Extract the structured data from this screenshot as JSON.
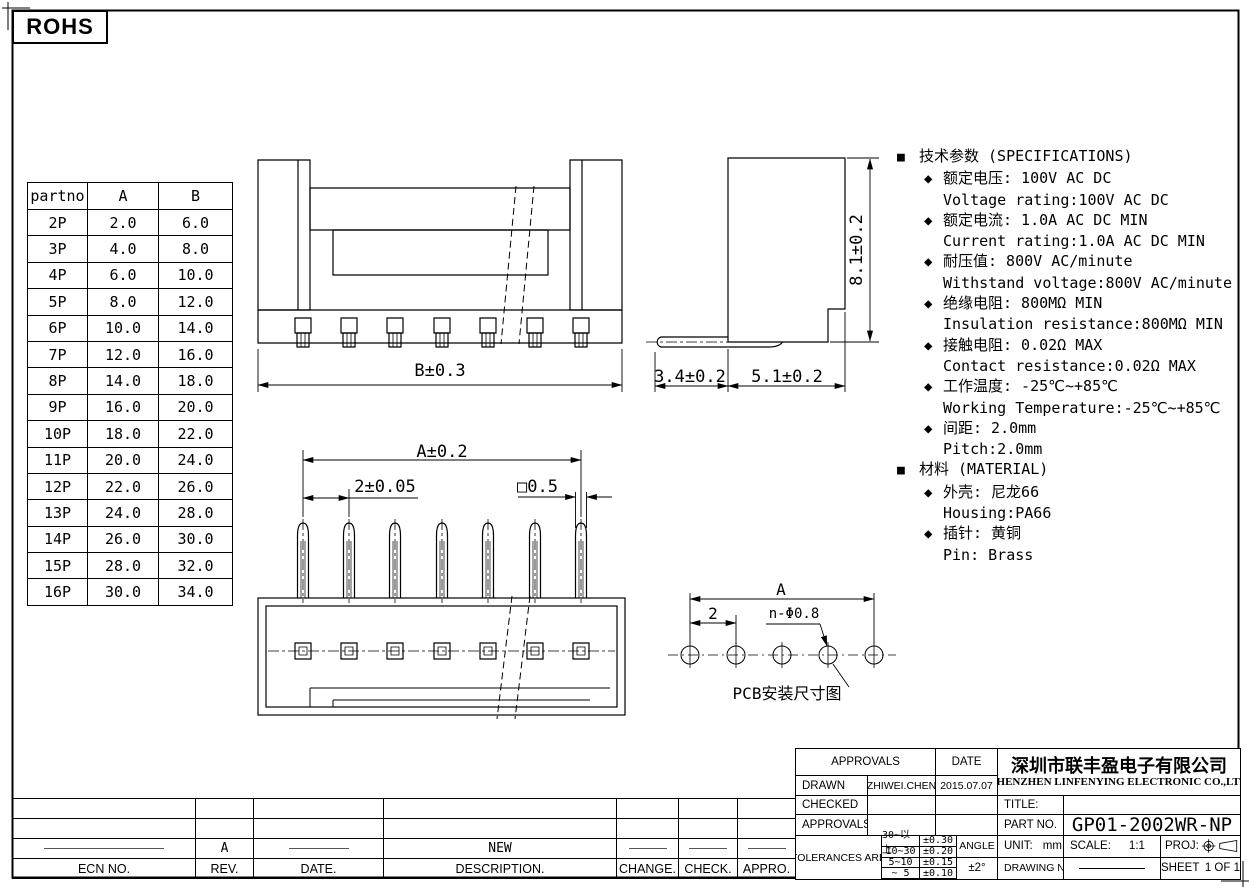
{
  "rohs": {
    "label": "ROHS"
  },
  "icons": {
    "square_bullet": "■",
    "diamond_bullet": "◆"
  },
  "part_table": {
    "headers": {
      "partno": "partno",
      "a": "A",
      "b": "B"
    },
    "rows": [
      {
        "partno": "2P",
        "a": "2.0",
        "b": "6.0"
      },
      {
        "partno": "3P",
        "a": "4.0",
        "b": "8.0"
      },
      {
        "partno": "4P",
        "a": "6.0",
        "b": "10.0"
      },
      {
        "partno": "5P",
        "a": "8.0",
        "b": "12.0"
      },
      {
        "partno": "6P",
        "a": "10.0",
        "b": "14.0"
      },
      {
        "partno": "7P",
        "a": "12.0",
        "b": "16.0"
      },
      {
        "partno": "8P",
        "a": "14.0",
        "b": "18.0"
      },
      {
        "partno": "9P",
        "a": "16.0",
        "b": "20.0"
      },
      {
        "partno": "10P",
        "a": "18.0",
        "b": "22.0"
      },
      {
        "partno": "11P",
        "a": "20.0",
        "b": "24.0"
      },
      {
        "partno": "12P",
        "a": "22.0",
        "b": "26.0"
      },
      {
        "partno": "13P",
        "a": "24.0",
        "b": "28.0"
      },
      {
        "partno": "14P",
        "a": "26.0",
        "b": "30.0"
      },
      {
        "partno": "15P",
        "a": "28.0",
        "b": "32.0"
      },
      {
        "partno": "16P",
        "a": "30.0",
        "b": "34.0"
      }
    ]
  },
  "specs": {
    "spec_heading": "技术参数 (SPECIFICATIONS)",
    "spec_items": [
      {
        "cn": "额定电压: 100V AC DC",
        "en": "Voltage rating:100V AC DC"
      },
      {
        "cn": "额定电流: 1.0A AC DC MIN",
        "en": "Current rating:1.0A AC DC MIN"
      },
      {
        "cn": "耐压值: 800V AC/minute",
        "en": "Withstand voltage:800V AC/minute"
      },
      {
        "cn": "绝缘电阻: 800MΩ MIN",
        "en": "Insulation resistance:800MΩ MIN"
      },
      {
        "cn": "接触电阻: 0.02Ω MAX",
        "en": "Contact resistance:0.02Ω MAX"
      },
      {
        "cn": "工作温度: -25℃~+85℃",
        "en": "Working Temperature:-25℃~+85℃"
      },
      {
        "cn": "间距: 2.0mm",
        "en": "Pitch:2.0mm"
      }
    ],
    "material_heading": "材料 (MATERIAL)",
    "material_items": [
      {
        "cn": "外壳: 尼龙66",
        "en": "Housing:PA66"
      },
      {
        "cn": "插针: 黄铜",
        "en": "Pin: Brass"
      }
    ]
  },
  "dimensions": {
    "front_width": "B±0.3",
    "top_width": "A±0.2",
    "pitch": "2±0.05",
    "pin_square": "□0.5",
    "side_height": "8.1±0.2",
    "pin_length": "3.4±0.2",
    "body_depth": "5.1±0.2"
  },
  "pcb": {
    "width_label": "A",
    "pitch_label": "2",
    "hole_label": "n-Φ0.8",
    "caption": "PCB安装尺寸图"
  },
  "revision": {
    "headers": [
      "ECN NO.",
      "REV.",
      "DATE.",
      "DESCRIPTION.",
      "CHANGE.",
      "CHECK.",
      "APPRO."
    ],
    "entry": {
      "rev": "A",
      "description": "NEW"
    }
  },
  "title_block": {
    "approvals_header": "APPROVALS",
    "date_header": "DATE",
    "drawn_label": "DRAWN",
    "drawn_name": "ZHIWEI.CHEN",
    "drawn_date": "2015.07.07",
    "checked_label": "CHECKED",
    "approved_label": "APPROVALS",
    "tolerances_label": "TOLERANCES ARE",
    "tolerances": [
      {
        "range": "30~以上",
        "tol": "±0.30"
      },
      {
        "range": "10~30",
        "tol": "±0.20"
      },
      {
        "range": "5~10",
        "tol": "±0.15"
      },
      {
        "range": "~ 5",
        "tol": "±0.10"
      }
    ],
    "angle_label": "ANGLE",
    "angle_tol": "±2°",
    "company_cn": "深圳市联丰盈电子有限公司",
    "company_en": "SHENZHEN LINFENYING ELECTRONIC CO.,LTD",
    "title_label": "TITLE:",
    "part_no_label": "PART NO.",
    "part_no": "GP01-2002WR-NP",
    "unit_label": "UNIT:",
    "unit_value": "mm",
    "scale_label": "SCALE:",
    "scale_value": "1:1",
    "proj_label": "PROJ:",
    "drawing_no_label": "DRAWING NO.",
    "sheet_label": "SHEET",
    "sheet_value": "1 OF 1"
  }
}
